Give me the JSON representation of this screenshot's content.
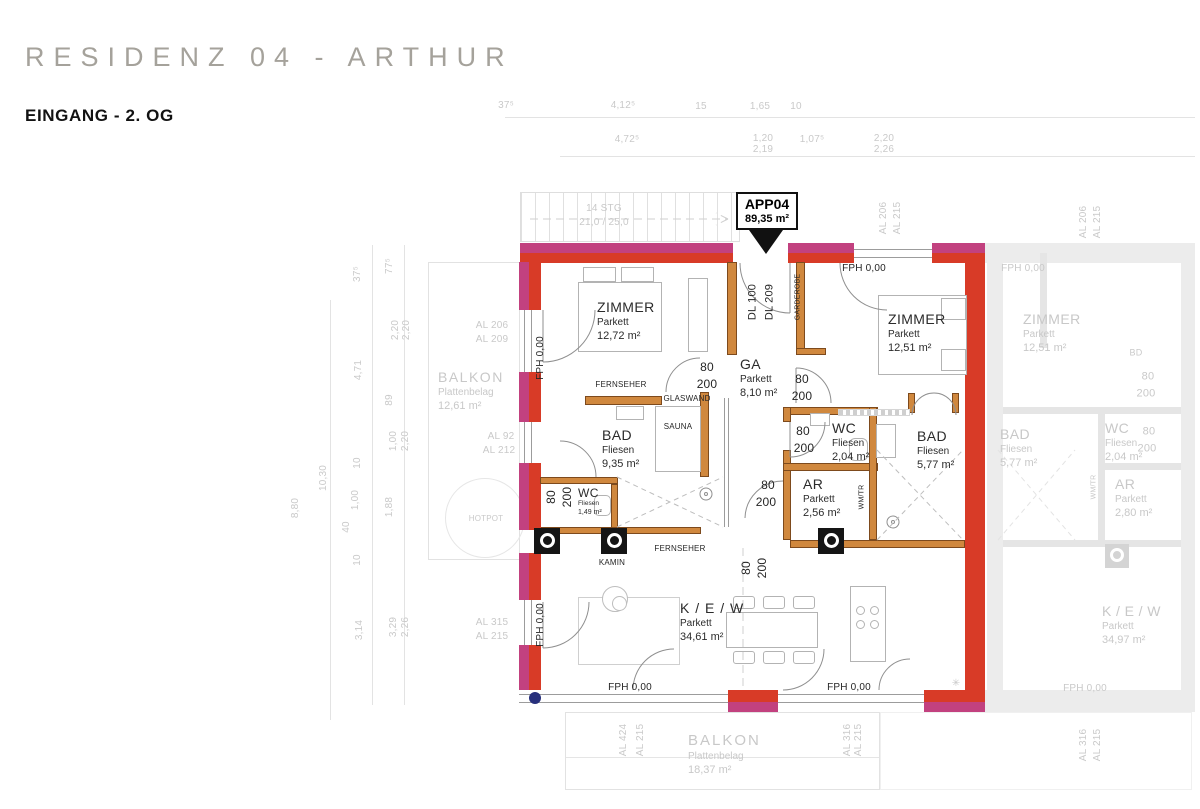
{
  "header": {
    "title": "RESIDENZ 04 - ARTHUR",
    "subtitle": "EINGANG - 2. OG"
  },
  "badge": {
    "id": "APP04",
    "area": "89,35 m²"
  },
  "palette": {
    "outer": "#c2417f",
    "load": "#d83b27",
    "int": "#d0883e",
    "dot": "#27307c"
  },
  "stairs": {
    "label1": "14 STG",
    "label2": "21,0 / 25,0"
  },
  "rooms": {
    "zimmer1": {
      "name": "ZIMMER",
      "floor": "Parkett",
      "area": "12,72 m²"
    },
    "zimmer2": {
      "name": "ZIMMER",
      "floor": "Parkett",
      "area": "12,51 m²"
    },
    "bad1": {
      "name": "BAD",
      "floor": "Fliesen",
      "area": "9,35 m²"
    },
    "wc1": {
      "name": "WC",
      "floor": "Fliesen",
      "area": "1,49 m²"
    },
    "ga": {
      "name": "GA",
      "floor": "Parkett",
      "area": "8,10 m²"
    },
    "wc2": {
      "name": "WC",
      "floor": "Fliesen",
      "area": "2,04 m²"
    },
    "ar": {
      "name": "AR",
      "floor": "Parkett",
      "area": "2,56 m²"
    },
    "bad2": {
      "name": "BAD",
      "floor": "Fliesen",
      "area": "5,77 m²"
    },
    "kew": {
      "name": "K / E / W",
      "floor": "Parkett",
      "area": "34,61 m²"
    },
    "balkon_left": {
      "name": "BALKON",
      "floor": "Plattenbelag",
      "area": "12,61 m²"
    },
    "balkon_bottom": {
      "name": "BALKON",
      "floor": "Plattenbelag",
      "area": "18,37 m²"
    },
    "faded_zimmer": {
      "name": "ZIMMER",
      "floor": "Parkett",
      "area": "12,51 m²"
    },
    "faded_bad": {
      "name": "BAD",
      "floor": "Fliesen",
      "area": "5,77 m²"
    },
    "faded_wc": {
      "name": "WC",
      "floor": "Fliesen",
      "area": "2,04 m²"
    },
    "faded_ar": {
      "name": "AR",
      "floor": "Parkett",
      "area": "2,80 m²"
    },
    "faded_kew": {
      "name": "K / E / W",
      "floor": "Parkett",
      "area": "34,97 m²"
    }
  },
  "annotations": [
    {
      "n": "feature-label-fernseher",
      "t": "FERNSEHER",
      "x": 621,
      "y": 385,
      "s": 8,
      "c": "dk"
    },
    {
      "n": "feature-label-glaswand",
      "t": "GLASWAND",
      "x": 687,
      "y": 399,
      "s": 8,
      "c": "dk"
    },
    {
      "n": "feature-label-sauna",
      "t": "SAUNA",
      "x": 678,
      "y": 427,
      "s": 8,
      "c": "dk"
    },
    {
      "n": "feature-label-kamin",
      "t": "KAMIN",
      "x": 612,
      "y": 563,
      "s": 8,
      "c": "dk"
    },
    {
      "n": "feature-label-fernseher-2",
      "t": "FERNSEHER",
      "x": 680,
      "y": 549,
      "s": 8,
      "c": "dk"
    },
    {
      "n": "feature-label-wm-tr",
      "t": "WM/TR",
      "x": 862,
      "y": 497,
      "s": 7,
      "r": -90,
      "c": "dk"
    },
    {
      "n": "feature-label-hotpot",
      "t": "HOTPOT",
      "x": 486,
      "y": 519,
      "s": 8,
      "c": "fd"
    },
    {
      "n": "fph-label",
      "t": "FPH 0,00",
      "x": 864,
      "y": 269,
      "s": 10,
      "c": "dk"
    },
    {
      "n": "fph-label",
      "t": "FPH 0,00",
      "x": 541,
      "y": 358,
      "s": 10,
      "r": -90,
      "c": "dk"
    },
    {
      "n": "fph-label",
      "t": "FPH 0,00",
      "x": 541,
      "y": 625,
      "s": 10,
      "r": -90,
      "c": "dk"
    },
    {
      "n": "fph-label",
      "t": "FPH 0,00",
      "x": 630,
      "y": 688,
      "s": 10,
      "c": "dk"
    },
    {
      "n": "fph-label",
      "t": "FPH 0,00",
      "x": 849,
      "y": 688,
      "s": 10,
      "c": "dk"
    },
    {
      "n": "fph-label",
      "t": "FPH 0,00",
      "x": 1023,
      "y": 269,
      "s": 10,
      "c": "fd"
    },
    {
      "n": "fph-label",
      "t": "FPH 0,00",
      "x": 1085,
      "y": 689,
      "s": 10,
      "c": "fd"
    },
    {
      "n": "entry-door-label",
      "t": "DL 100",
      "x": 753,
      "y": 302,
      "s": 11,
      "r": -90,
      "c": "dk"
    },
    {
      "n": "entry-door-label",
      "t": "DL 209",
      "x": 770,
      "y": 302,
      "s": 11,
      "r": -90,
      "c": "dk"
    },
    {
      "n": "feature-label-garderobe",
      "t": "GARDEROBE",
      "x": 798,
      "y": 297,
      "s": 7,
      "r": -90,
      "c": "dk"
    },
    {
      "n": "door-size-label",
      "t": "80",
      "x": 707,
      "y": 367,
      "s": 12,
      "c": "dk"
    },
    {
      "n": "door-size-label",
      "t": "200",
      "x": 707,
      "y": 384,
      "s": 12,
      "c": "dk"
    },
    {
      "n": "door-size-label",
      "t": "80",
      "x": 802,
      "y": 379,
      "s": 12,
      "c": "dk"
    },
    {
      "n": "door-size-label",
      "t": "200",
      "x": 802,
      "y": 396,
      "s": 12,
      "c": "dk"
    },
    {
      "n": "door-size-label",
      "t": "80",
      "x": 803,
      "y": 431,
      "s": 12,
      "c": "dk"
    },
    {
      "n": "door-size-label",
      "t": "200",
      "x": 804,
      "y": 448,
      "s": 12,
      "c": "dk"
    },
    {
      "n": "door-size-label",
      "t": "80",
      "x": 768,
      "y": 485,
      "s": 12,
      "c": "dk"
    },
    {
      "n": "door-size-label",
      "t": "200",
      "x": 766,
      "y": 502,
      "s": 12,
      "c": "dk"
    },
    {
      "n": "door-size-label",
      "t": "80",
      "x": 551,
      "y": 497,
      "s": 12,
      "r": -90,
      "c": "dk"
    },
    {
      "n": "door-size-label",
      "t": "200",
      "x": 567,
      "y": 497,
      "s": 12,
      "r": -90,
      "c": "dk"
    },
    {
      "n": "door-size-label",
      "t": "80",
      "x": 746,
      "y": 568,
      "s": 12,
      "r": -90,
      "c": "dk"
    },
    {
      "n": "door-size-label",
      "t": "200",
      "x": 762,
      "y": 568,
      "s": 12,
      "r": -90,
      "c": "dk"
    },
    {
      "n": "door-size-label",
      "t": "80",
      "x": 1148,
      "y": 377,
      "s": 11,
      "c": "fd"
    },
    {
      "n": "door-size-label",
      "t": "200",
      "x": 1146,
      "y": 394,
      "s": 11,
      "c": "fd"
    },
    {
      "n": "door-size-label",
      "t": "80",
      "x": 1149,
      "y": 432,
      "s": 11,
      "c": "fd"
    },
    {
      "n": "door-size-label",
      "t": "200",
      "x": 1147,
      "y": 449,
      "s": 11,
      "c": "fd"
    },
    {
      "n": "feature-label-bd",
      "t": "BD",
      "x": 1136,
      "y": 353,
      "s": 9,
      "c": "fd"
    },
    {
      "n": "feature-label-wm-tr",
      "t": "WM/TR",
      "x": 1094,
      "y": 487,
      "s": 7,
      "r": -90,
      "c": "fd"
    },
    {
      "n": "star-symbol",
      "t": "✳",
      "x": 956,
      "y": 684,
      "s": 10,
      "c": "fd"
    },
    {
      "n": "stairs-label",
      "t": "14 STG",
      "x": 604,
      "y": 209,
      "s": 10,
      "c": "dm"
    },
    {
      "n": "stairs-label",
      "t": "21,0 / 25,0",
      "x": 604,
      "y": 223,
      "s": 10,
      "c": "dm"
    },
    {
      "n": "dim-label",
      "t": "37⁵",
      "x": 506,
      "y": 106,
      "s": 10,
      "c": "dm"
    },
    {
      "n": "dim-label",
      "t": "4,12⁵",
      "x": 623,
      "y": 106,
      "s": 10,
      "c": "dm"
    },
    {
      "n": "dim-label",
      "t": "15",
      "x": 701,
      "y": 107,
      "s": 10,
      "c": "dm"
    },
    {
      "n": "dim-label",
      "t": "1,65",
      "x": 760,
      "y": 107,
      "s": 10,
      "c": "dm"
    },
    {
      "n": "dim-label",
      "t": "10",
      "x": 796,
      "y": 107,
      "s": 10,
      "c": "dm"
    },
    {
      "n": "dim-label",
      "t": "4,72⁵",
      "x": 627,
      "y": 140,
      "s": 10,
      "c": "dm"
    },
    {
      "n": "dim-label",
      "t": "1,20",
      "x": 763,
      "y": 139,
      "s": 10,
      "c": "dm"
    },
    {
      "n": "dim-label",
      "t": "2,19",
      "x": 763,
      "y": 150,
      "s": 10,
      "c": "dm"
    },
    {
      "n": "dim-label",
      "t": "1,07⁵",
      "x": 812,
      "y": 140,
      "s": 10,
      "c": "dm"
    },
    {
      "n": "dim-label",
      "t": "2,20",
      "x": 884,
      "y": 139,
      "s": 10,
      "c": "dm"
    },
    {
      "n": "dim-label",
      "t": "2,26",
      "x": 884,
      "y": 150,
      "s": 10,
      "c": "dm"
    },
    {
      "n": "dim-label",
      "t": "37⁵",
      "x": 358,
      "y": 274,
      "s": 10,
      "r": -90,
      "c": "dm"
    },
    {
      "n": "dim-label",
      "t": "77⁵",
      "x": 390,
      "y": 266,
      "s": 10,
      "r": -90,
      "c": "dm"
    },
    {
      "n": "dim-label",
      "t": "2,20",
      "x": 396,
      "y": 330,
      "s": 10,
      "r": -90,
      "c": "dm"
    },
    {
      "n": "dim-label",
      "t": "2,20",
      "x": 407,
      "y": 330,
      "s": 10,
      "r": -90,
      "c": "dm"
    },
    {
      "n": "dim-label",
      "t": "4,71",
      "x": 359,
      "y": 370,
      "s": 10,
      "r": -90,
      "c": "dm"
    },
    {
      "n": "dim-label",
      "t": "89",
      "x": 390,
      "y": 400,
      "s": 10,
      "r": -90,
      "c": "dm"
    },
    {
      "n": "dim-label",
      "t": "1,00",
      "x": 394,
      "y": 441,
      "s": 10,
      "r": -90,
      "c": "dm"
    },
    {
      "n": "dim-label",
      "t": "2,20",
      "x": 406,
      "y": 441,
      "s": 10,
      "r": -90,
      "c": "dm"
    },
    {
      "n": "dim-label",
      "t": "10",
      "x": 358,
      "y": 463,
      "s": 10,
      "r": -90,
      "c": "dm"
    },
    {
      "n": "dim-label",
      "t": "10,30",
      "x": 324,
      "y": 478,
      "s": 10,
      "r": -90,
      "c": "dm"
    },
    {
      "n": "dim-label",
      "t": "8,80",
      "x": 296,
      "y": 508,
      "s": 10,
      "r": -90,
      "c": "dm"
    },
    {
      "n": "dim-label",
      "t": "1,00",
      "x": 356,
      "y": 500,
      "s": 10,
      "r": -90,
      "c": "dm"
    },
    {
      "n": "dim-label",
      "t": "40",
      "x": 347,
      "y": 527,
      "s": 10,
      "r": -90,
      "c": "dm"
    },
    {
      "n": "dim-label",
      "t": "10",
      "x": 358,
      "y": 560,
      "s": 10,
      "r": -90,
      "c": "dm"
    },
    {
      "n": "dim-label",
      "t": "1,88",
      "x": 390,
      "y": 507,
      "s": 10,
      "r": -90,
      "c": "dm"
    },
    {
      "n": "dim-label",
      "t": "3,14",
      "x": 360,
      "y": 630,
      "s": 10,
      "r": -90,
      "c": "dm"
    },
    {
      "n": "dim-label",
      "t": "3,29",
      "x": 394,
      "y": 627,
      "s": 10,
      "r": -90,
      "c": "dm"
    },
    {
      "n": "dim-label",
      "t": "2,26",
      "x": 406,
      "y": 627,
      "s": 10,
      "r": -90,
      "c": "dm"
    },
    {
      "n": "al-ref-label",
      "t": "AL 206",
      "x": 492,
      "y": 326,
      "s": 10,
      "c": "fd"
    },
    {
      "n": "al-ref-label",
      "t": "AL 209",
      "x": 492,
      "y": 340,
      "s": 10,
      "c": "fd"
    },
    {
      "n": "al-ref-label",
      "t": "AL 92",
      "x": 501,
      "y": 437,
      "s": 10,
      "c": "fd"
    },
    {
      "n": "al-ref-label",
      "t": "AL 212",
      "x": 499,
      "y": 451,
      "s": 10,
      "c": "fd"
    },
    {
      "n": "al-ref-label",
      "t": "AL 315",
      "x": 492,
      "y": 623,
      "s": 10,
      "c": "fd"
    },
    {
      "n": "al-ref-label",
      "t": "AL 215",
      "x": 492,
      "y": 637,
      "s": 10,
      "c": "fd"
    },
    {
      "n": "al-ref-label",
      "t": "AL 206",
      "x": 884,
      "y": 218,
      "s": 10,
      "r": -90,
      "c": "fd"
    },
    {
      "n": "al-ref-label",
      "t": "AL 215",
      "x": 898,
      "y": 218,
      "s": 10,
      "r": -90,
      "c": "fd"
    },
    {
      "n": "al-ref-label",
      "t": "AL 424",
      "x": 624,
      "y": 740,
      "s": 10,
      "r": -90,
      "c": "fd"
    },
    {
      "n": "al-ref-label",
      "t": "AL 215",
      "x": 641,
      "y": 740,
      "s": 10,
      "r": -90,
      "c": "fd"
    },
    {
      "n": "al-ref-label",
      "t": "AL 316",
      "x": 848,
      "y": 740,
      "s": 10,
      "r": -90,
      "c": "fd"
    },
    {
      "n": "al-ref-label",
      "t": "AL 215",
      "x": 859,
      "y": 740,
      "s": 10,
      "r": -90,
      "c": "fd"
    },
    {
      "n": "al-ref-label",
      "t": "AL 206",
      "x": 1084,
      "y": 222,
      "s": 10,
      "r": -90,
      "c": "fd"
    },
    {
      "n": "al-ref-label",
      "t": "AL 215",
      "x": 1098,
      "y": 222,
      "s": 10,
      "r": -90,
      "c": "fd"
    },
    {
      "n": "al-ref-label",
      "t": "AL 316",
      "x": 1084,
      "y": 745,
      "s": 10,
      "r": -90,
      "c": "fd"
    },
    {
      "n": "al-ref-label",
      "t": "AL 215",
      "x": 1098,
      "y": 745,
      "s": 10,
      "r": -90,
      "c": "fd"
    }
  ]
}
